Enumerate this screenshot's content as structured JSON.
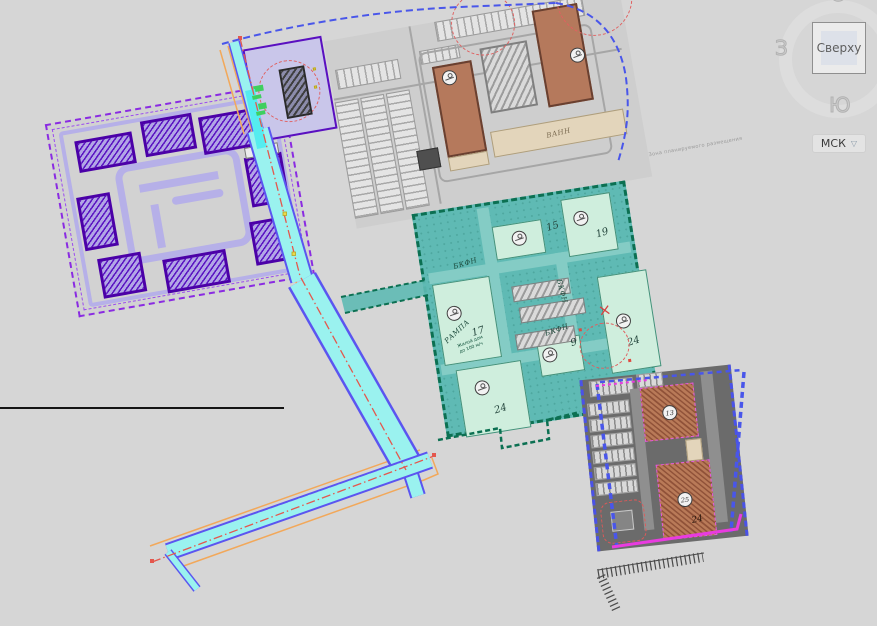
{
  "viewcube": {
    "top_btn": "Сверху",
    "west": "З",
    "south": "Ю",
    "north": "С"
  },
  "crs": {
    "label": "МСК",
    "chevron": "▽"
  },
  "plan": {
    "purple": {
      "ramp": "Рампа"
    },
    "gray": {
      "strip": "ВАНН"
    },
    "edge_note": "Зона планируемого размещения",
    "teal": {
      "bkfn_top": "БКФН",
      "bkfn_right": "БКФН",
      "bkfn_small": "БКФН",
      "rampa": "РАМПА",
      "n15": "15",
      "n17": "17",
      "n19": "19",
      "n24r": "24",
      "n24b": "24",
      "n9": "9",
      "note1": "Жилой дом",
      "note2": "до 100 м/ч"
    },
    "dark": {
      "m13": "13",
      "m25": "25",
      "n24": "24"
    }
  },
  "colors": {
    "background": "#d6d6d6",
    "purple_zone": "#5a14c2",
    "teal_zone": "#5fbab4",
    "dark_zone": "#6b6b6b",
    "road_cyan": "#9af2ef",
    "boundary_blue": "#4956ea",
    "boundary_green": "#0c7052",
    "magenta": "#e93be0",
    "utility_orange": "#f2a85a",
    "centerline_red": "#e4574d"
  }
}
